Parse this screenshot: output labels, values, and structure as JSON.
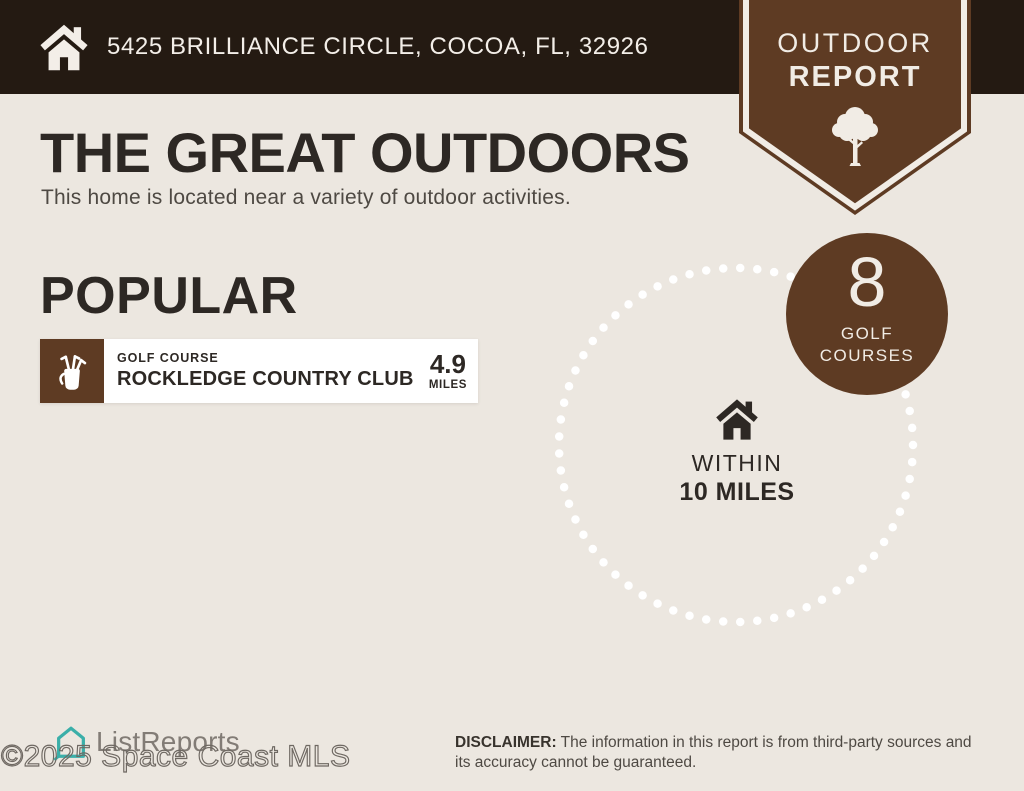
{
  "colors": {
    "background": "#ece7e0",
    "header_bar": "#241a12",
    "brand_brown": "#5e3b23",
    "text_dark": "#2d2824",
    "text_gray": "#4e4943",
    "logo_teal": "#3bafa9",
    "card_white": "#ffffff"
  },
  "header": {
    "address": "5425 BRILLIANCE CIRCLE, COCOA, FL, 32926",
    "icon": "house-icon"
  },
  "ribbon": {
    "line1": "OUTDOOR",
    "line2": "REPORT",
    "icon": "tree-icon"
  },
  "intro": {
    "title": "THE GREAT OUTDOORS",
    "subtitle": "This home is located near a variety of outdoor activities."
  },
  "popular": {
    "heading": "POPULAR",
    "items": [
      {
        "category": "GOLF COURSE",
        "name": "ROCKLEDGE COUNTRY CLUB",
        "distance_value": "4.9",
        "distance_unit": "MILES",
        "icon": "golf-bag-icon"
      }
    ]
  },
  "radius": {
    "center_icon": "house-icon",
    "within_label": "WITHIN",
    "distance_label": "10 MILES",
    "badge": {
      "count": "8",
      "label1": "GOLF",
      "label2": "COURSES"
    }
  },
  "footer": {
    "brand": "ListReports",
    "logo_icon": "listreports-house-icon",
    "watermark": "©2025 Space Coast MLS",
    "disclaimer_label": "DISCLAIMER:",
    "disclaimer_text": " The information in this report is from third-party sources and its accuracy cannot be guaranteed."
  }
}
